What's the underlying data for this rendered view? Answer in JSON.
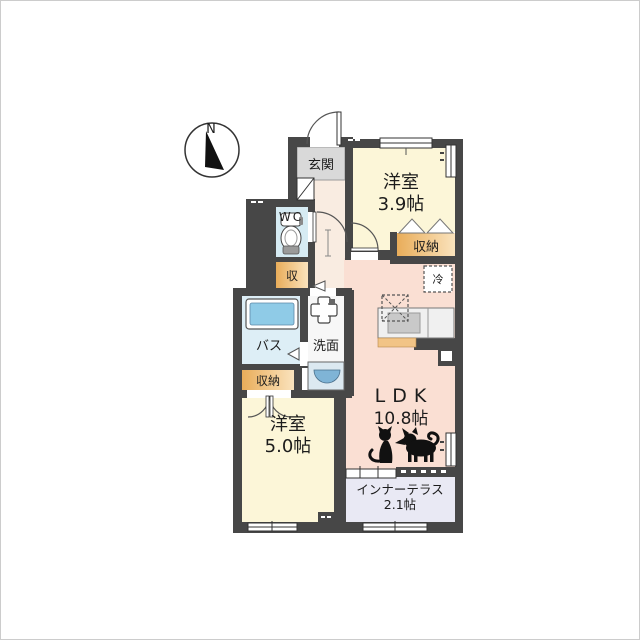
{
  "compass": {
    "north_label": "N"
  },
  "rooms": {
    "genkan": {
      "label": "玄関"
    },
    "bedroom_39": {
      "label": "洋室",
      "area": "3.9帖"
    },
    "closet_39": {
      "label": "収納"
    },
    "wc": {
      "label": "WC"
    },
    "storage_hall": {
      "label": "収"
    },
    "bath": {
      "label": "バス"
    },
    "washroom": {
      "label": "洗面"
    },
    "closet_bath": {
      "label": "収納"
    },
    "bedroom_50": {
      "label": "洋室",
      "area": "5.0帖"
    },
    "ldk": {
      "label": "LDK",
      "area": "10.8帖"
    },
    "inner_terrace": {
      "label": "インナーテラス",
      "area": "2.1帖"
    },
    "refrigerator": {
      "label": "冷"
    }
  },
  "colors": {
    "wall": "#474747",
    "bedroom": "#fcf6d8",
    "ldk": "#fadfd3",
    "hallway": "#f9ece1",
    "genkan_floor": "#d9d9d9",
    "wc": "#d6ebf3",
    "bath": "#ddeef6",
    "bathtub": "#8fcbe7",
    "closet_start": "#e9ad5a",
    "closet_end": "#fae3bd",
    "terrace": "#e9e9f4",
    "sink": "#7fb4d6",
    "counter_accent": "#f2c486",
    "silhouette": "#111111"
  }
}
